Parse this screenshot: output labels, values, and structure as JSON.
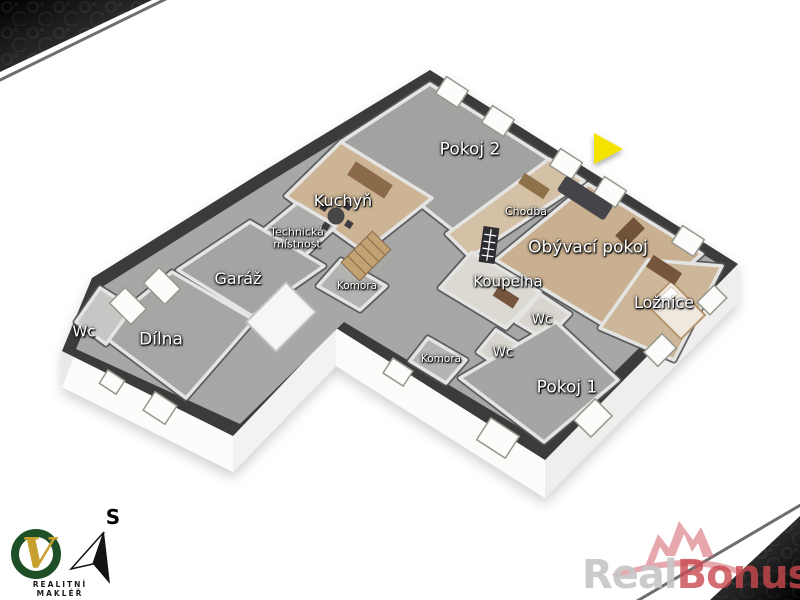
{
  "floorplan": {
    "rooms": {
      "pokoj2": {
        "label": "Pokoj 2"
      },
      "kuchyn": {
        "label": "Kuchyň"
      },
      "technicka": {
        "line1": "Technická",
        "line2": "místnost"
      },
      "garaz": {
        "label": "Garáž"
      },
      "komora1": {
        "label": "Komora"
      },
      "wc_left": {
        "label": "Wc"
      },
      "dilna": {
        "label": "Dílna"
      },
      "chodba": {
        "label": "Chodba"
      },
      "obyvaci": {
        "label": "Obývací pokoj"
      },
      "koupelna": {
        "label": "Koupelna"
      },
      "wc_mid": {
        "label": "Wc"
      },
      "loznice": {
        "label": "Ložnice"
      },
      "wc_low": {
        "label": "Wc"
      },
      "komora2": {
        "label": "Komora"
      },
      "pokoj1": {
        "label": "Pokoj 1"
      }
    }
  },
  "arrow": {
    "color": "#f4e202"
  },
  "compass": {
    "label": "S"
  },
  "logo": {
    "monogram": "V",
    "tagline": "REALITNÍ MAKLÉŘ",
    "ring_color": "#1f4f26",
    "monogram_color": "#c7a030"
  },
  "watermark": {
    "part1": "Real",
    "part2": "Bonus",
    "suffix": "cz",
    "part1_color": "#c6c6c6",
    "part2_color": "#c9494f",
    "crown_color": "#d4626b"
  },
  "colors": {
    "outer_wall": "#3a3a3a",
    "floor_concrete": "#a7a7a5",
    "floor_wood": "#c9b090",
    "floor_tile": "#dcd9d2",
    "corner_decor": "#111111",
    "diagonal_line": "#6e6e6e"
  }
}
